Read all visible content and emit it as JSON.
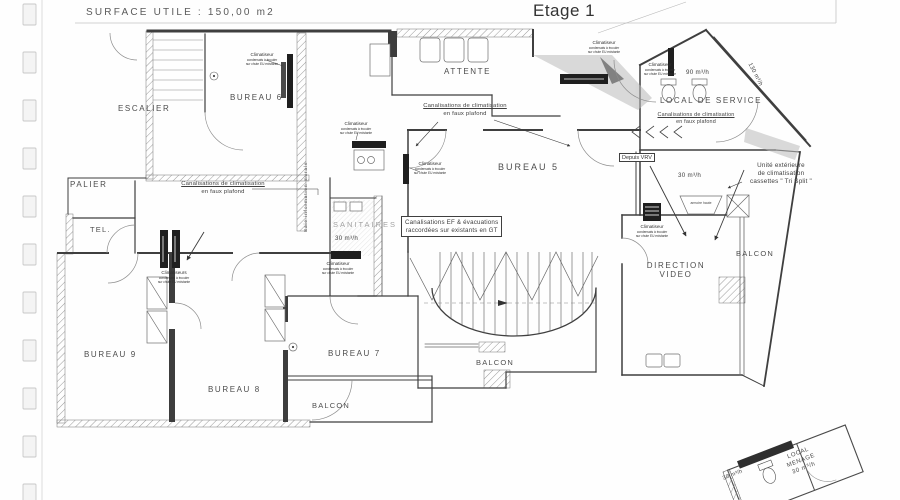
{
  "page": {
    "surface_label": "SURFACE UTILE : 150,00 m2",
    "title": "Etage 1"
  },
  "rooms": {
    "escalier": "ESCALIER",
    "bureau6": "BUREAU 6",
    "attente": "ATTENTE",
    "bureau5": "BUREAU 5",
    "local_de_service": "LOCAL DE SERVICE",
    "palier": "PALIER",
    "tel": "TEL.",
    "sanitaires": "SANITAIRES",
    "bureau9": "BUREAU 9",
    "bureau8": "BUREAU 8",
    "bureau7": "BUREAU 7",
    "balcon": "BALCON",
    "direction_video": {
      "line1": "DIRECTION",
      "line2": "VIDEO"
    },
    "local_menage": {
      "line1": "LOCAL",
      "line2": "MENAGE",
      "line3": "30 m³/h"
    }
  },
  "annotations": {
    "canalisations": {
      "line1": "Canalisations de climatisation",
      "line2": "en faux plafond"
    },
    "ef": {
      "line1": "Canalisations EF & évacuations",
      "line2": "raccordées sur existants en GT"
    },
    "tri_split": {
      "line1": "Unité extérieure",
      "line2": "de climatisation",
      "line3": "cassettes \" Tri Split \""
    },
    "depuis_vrv": "Depuis VRV",
    "climatiseur": {
      "title": "Climatiseur",
      "line1": "condensats à écouler",
      "line2": "sur chute EU existante"
    },
    "climatiseurs_title": "Climatiseurs",
    "baie_info": "Baie information murale",
    "armoire_haute": "armoire haute"
  },
  "airflow": {
    "f90": "90 m³/h",
    "f130": "130 m³/h",
    "f30": "30 m³/h"
  }
}
